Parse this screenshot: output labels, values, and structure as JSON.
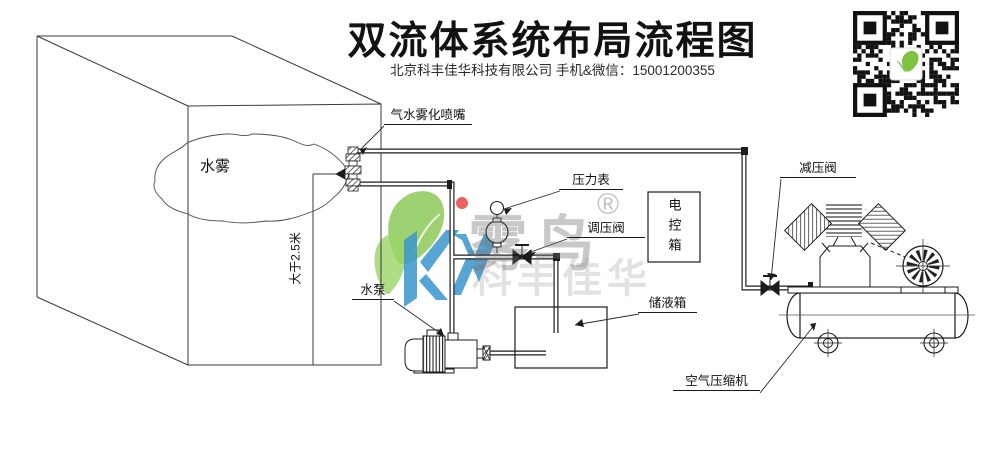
{
  "header": {
    "title": "双流体系统布局流程图",
    "subtitle": "北京科丰佳华科技有限公司 手机&微信：15001200355"
  },
  "diagram": {
    "labels": {
      "water_mist": "水雾",
      "nozzle": "气水雾化喷嘴",
      "pressure_gauge": "压力表",
      "regulating_valve": "调压阀",
      "control_box": "电控箱",
      "reducing_valve": "减压阀",
      "height_dim": "大于2.5米",
      "water_pump": "水泵",
      "storage_tank": "储液箱",
      "air_compressor": "空气压缩机"
    },
    "watermark": {
      "brand": "雾鸟",
      "reg_mark": "®",
      "sub_text": "科丰佳华",
      "leaf_color": "#7dc242",
      "letter_color": "#1e88c7",
      "dot_color": "#e53935"
    },
    "colors": {
      "line": "#2a2a2a",
      "title_text": "#121212"
    }
  }
}
